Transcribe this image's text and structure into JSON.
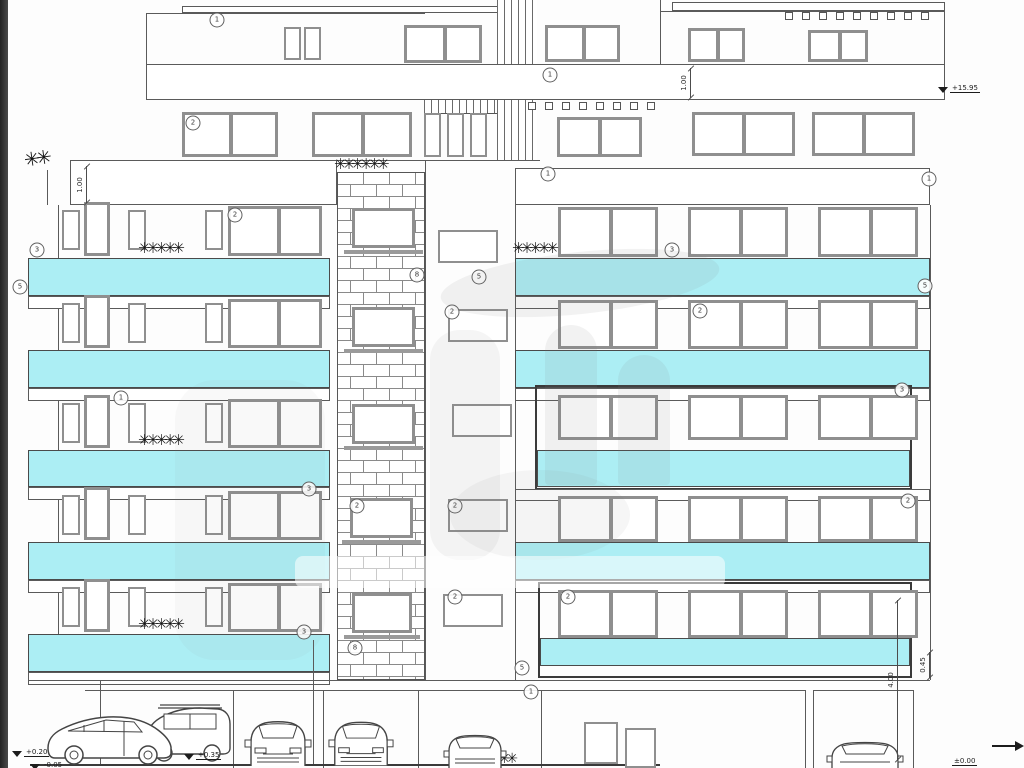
{
  "drawing": {
    "type": "building-front-elevation",
    "colors": {
      "balcony_band": "#aceef4",
      "line": "#5a5a5a",
      "window_frame": "#8f8f8f",
      "accent_frame": "#3a3a3a"
    },
    "annotations": [
      {
        "label": "1",
        "x": 217,
        "y": 20
      },
      {
        "label": "1",
        "x": 550,
        "y": 75
      },
      {
        "label": "2",
        "x": 193,
        "y": 123
      },
      {
        "label": "1",
        "x": 548,
        "y": 174
      },
      {
        "label": "1",
        "x": 929,
        "y": 179
      },
      {
        "label": "2",
        "x": 235,
        "y": 215
      },
      {
        "label": "3",
        "x": 37,
        "y": 250
      },
      {
        "label": "3",
        "x": 672,
        "y": 250
      },
      {
        "label": "8",
        "x": 417,
        "y": 275
      },
      {
        "label": "5",
        "x": 479,
        "y": 277
      },
      {
        "label": "5",
        "x": 20,
        "y": 287
      },
      {
        "label": "5",
        "x": 925,
        "y": 286
      },
      {
        "label": "2",
        "x": 700,
        "y": 311
      },
      {
        "label": "2",
        "x": 452,
        "y": 312
      },
      {
        "label": "1",
        "x": 121,
        "y": 398
      },
      {
        "label": "3",
        "x": 902,
        "y": 390
      },
      {
        "label": "3",
        "x": 309,
        "y": 489
      },
      {
        "label": "2",
        "x": 908,
        "y": 501
      },
      {
        "label": "2",
        "x": 357,
        "y": 506
      },
      {
        "label": "2",
        "x": 455,
        "y": 506
      },
      {
        "label": "2",
        "x": 568,
        "y": 597
      },
      {
        "label": "2",
        "x": 455,
        "y": 597
      },
      {
        "label": "3",
        "x": 304,
        "y": 632
      },
      {
        "label": "8",
        "x": 355,
        "y": 648
      },
      {
        "label": "5",
        "x": 522,
        "y": 668
      },
      {
        "label": "1",
        "x": 531,
        "y": 692
      }
    ],
    "level_markers": [
      {
        "label": "+15.95",
        "x": 938,
        "y": 84,
        "tri": true
      },
      {
        "label": "+0.20",
        "x": 12,
        "y": 748,
        "tri": true
      },
      {
        "label": "-0.05",
        "x": 30,
        "y": 761,
        "tri": true
      },
      {
        "label": "+0.35",
        "x": 184,
        "y": 751,
        "tri": true
      },
      {
        "label": "±0.00",
        "x": 952,
        "y": 757,
        "tri": false
      }
    ],
    "dimensions": [
      {
        "label": "1.00",
        "x": 86,
        "y1": 166,
        "y2": 203
      },
      {
        "label": "1.00",
        "x": 690,
        "y1": 68,
        "y2": 98
      },
      {
        "label": "0.45",
        "x": 929,
        "y1": 652,
        "y2": 678
      },
      {
        "label": "4.00",
        "x": 897,
        "y1": 600,
        "y2": 760
      }
    ]
  }
}
